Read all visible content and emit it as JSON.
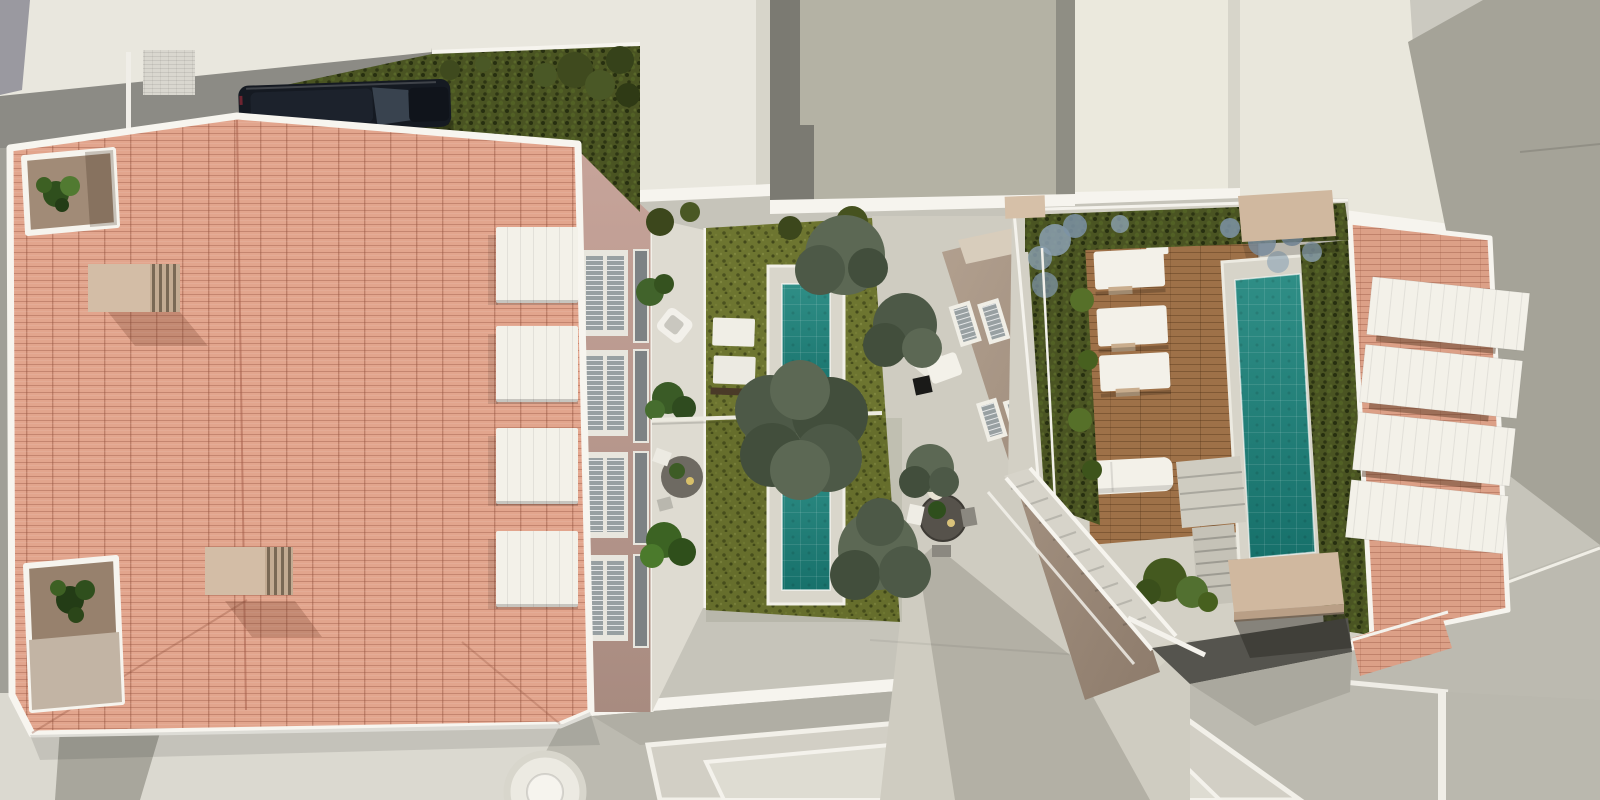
{
  "meta": {
    "title": "Aerial 3D architectural rendering of a residential courtyard block",
    "view": "top-down drone view",
    "width_px": 1600,
    "height_px": 800,
    "visible_text": "none"
  },
  "scene": {
    "areas": [
      {
        "name": "left-residential-building",
        "features": [
          "terracotta-tile-hip-roof",
          "white-roof-trim",
          "two-roof-light-wells-with-plants",
          "two-beige-roof-vents",
          "pink-courtyard-facade",
          "four-white-window-awnings",
          "balcony-terrace-with-furniture"
        ]
      },
      {
        "name": "central-garden",
        "features": [
          "two-private-lawns",
          "two-plunge-pools",
          "mature-gray-green-trees",
          "two-sun-loungers",
          "garden-divider-wall",
          "planters"
        ]
      },
      {
        "name": "central-paved-courtyard",
        "features": [
          "round-dining-table-with-plant",
          "folded-lounge-chair",
          "black-side-table",
          "paved-walkway"
        ]
      },
      {
        "name": "middle-building",
        "features": [
          "taupe-facade-seen-obliquely",
          "white-framed-shuttered-windows",
          "cream-parapet"
        ]
      },
      {
        "name": "right-roof-terrace",
        "features": [
          "hardwood-deck",
          "three-white-sun-loungers",
          "white-outdoor-sofa",
          "teal-lap-pool",
          "perimeter-hedge-with-blue-flowers",
          "descending-staircase-with-white-rails",
          "terrace-steps",
          "two-beige-canopy-slabs",
          "garage-ramp-opening"
        ]
      },
      {
        "name": "right-residential-building",
        "features": [
          "terracotta-tile-roof",
          "four-white-roof-panels",
          "brick-parapet-with-railing"
        ]
      },
      {
        "name": "neighboring-buildings",
        "features": [
          "cream-flat-roofs",
          "gray-party-walls",
          "olive-gray-roof-deck"
        ]
      },
      {
        "name": "street-level",
        "features": [
          "dark-parked-suv",
          "street-hedge-strip-with-vines",
          "light-pavement",
          "lower-building-roofs",
          "round-skylight-drum"
        ]
      }
    ],
    "counts": {
      "pools": 3,
      "deck_loungers": 3,
      "roof_awnings": 4,
      "roof_panels": 4,
      "garden_trees": 5,
      "parked_cars": 1,
      "roof_light_wells": 2,
      "roof_vents": 2
    }
  },
  "colors": {
    "bg-pavement": "#c6c4ba",
    "pavement-light": "#dbd9d0",
    "pavement-mid": "#cfccc1",
    "street": "#bcbab0",
    "street-dark": "#a8a69c",
    "white-trim": "#f6f4ee",
    "cream-building": "#e9e7de",
    "cream-dark": "#d7d5ca",
    "gray-roof": "#b4b2a4",
    "gray-dark": "#7b7a72",
    "wall-right": "#a5a398",
    "wall-light": "#cbc9c0",
    "shadow-band": "#8c8b85",
    "roof-tile": "#e2a58d",
    "roof-tile-2": "#dca087",
    "facade-pink-1": "#c7a49a",
    "facade-pink-2": "#a88b80",
    "taupe-1": "#b2a08f",
    "taupe-2": "#8d7b6b",
    "awning": "#f3f1e9",
    "hedge": "#4a5422",
    "lawn": "#6d7530",
    "tree-1": "#5c6854",
    "tree-2": "#4d5947",
    "tree-3": "#424e3c",
    "plant-green-1": "#2f4f1d",
    "plant-green-2": "#517a31",
    "pool-1": "#2f8e86",
    "pool-2": "#17716b",
    "deck-wood": "#9e7148",
    "beige-slab": "#d0b89f",
    "chimney": "#d3bda6",
    "tan-floor": "#a18b77",
    "car-body": "#151a22",
    "car-glass": "#39434f",
    "blue-flower": "#8ba0b1",
    "window-glass": "#98a0a2",
    "dark-opening": "#55544e",
    "sofa-white": "#f3f1e9",
    "table-dark": "#56524b",
    "cube-black": "#1a1a18"
  }
}
